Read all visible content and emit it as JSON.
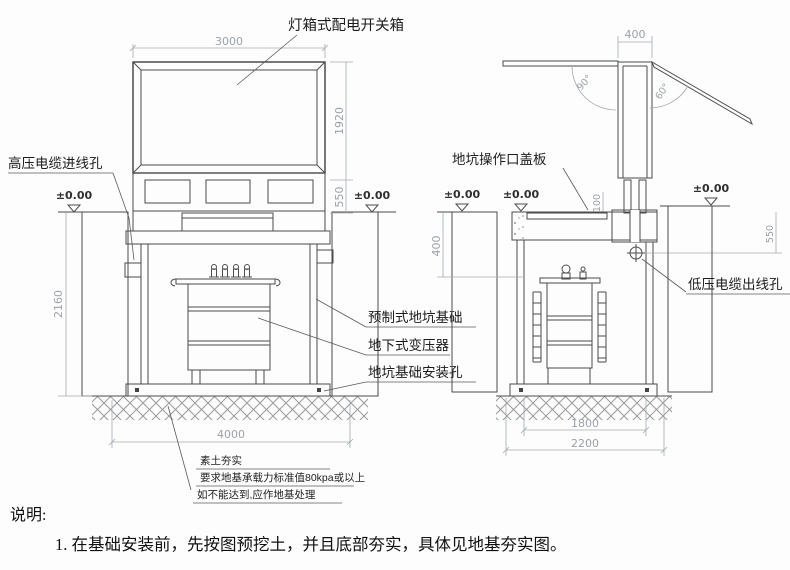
{
  "labels": {
    "lightbox_switchbox": "灯箱式配电开关箱",
    "hv_cable_inlet": "高压电缆进线孔",
    "precast_pit_foundation": "预制式地坑基础",
    "underground_transformer": "地下式变压器",
    "pit_foundation_mounting_hole": "地坑基础安装孔",
    "pit_access_cover": "地坑操作口盖板",
    "lv_cable_outlet": "低压电缆出线孔"
  },
  "dimensions": {
    "cabinet_width": "3000",
    "cabinet_height": "1920",
    "cabinet_base_height": "550",
    "pit_depth": "2160",
    "pit_excavation_width": "4000",
    "chimney_width": "400",
    "cover_open_angle_left": "90°",
    "cover_open_angle_right": "60°",
    "opening_offset": "100",
    "buried_depth": "400",
    "slab_edge_depth": "550",
    "pit_inner_width": "1800",
    "pit_outer_width": "2200",
    "ground_level": "±0.00"
  },
  "ground_notes": {
    "line1": "素土夯实",
    "line2": "要求地基承载力标准值80kpa或以上",
    "line3": "如不能达到,应作地基处理"
  },
  "description": {
    "heading": "说明:",
    "item1": "1. 在基础安装前，先按图预挖土，并且底部夯实，具体见地基夯实图。"
  },
  "colors": {
    "line": "#4c4c4c",
    "dimension": "#a3a9ae",
    "label": "#1c1c1c",
    "background": "#fdfdfd"
  }
}
